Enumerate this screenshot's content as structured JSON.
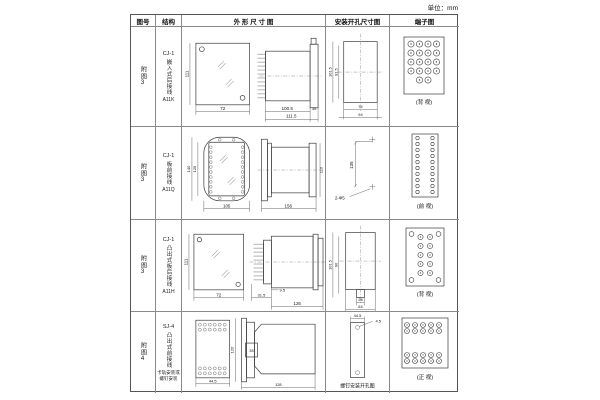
{
  "unit_note": "单位：mm",
  "headers": {
    "fig_no": "图号",
    "structure": "结构",
    "outline": "外 形 尺 寸 图",
    "install": "安装开孔尺寸图",
    "terminal": "端子图"
  },
  "rows": [
    {
      "fig_no": "附图3",
      "model": "CJ-1",
      "type": "嵌入式后接线",
      "code": "A11K",
      "outline": {
        "front_h": "111",
        "front_w": "72",
        "side_w1": "100.5",
        "side_w2": "111.5",
        "side_d": "35"
      },
      "install": {
        "v1": "101.5",
        "v2": "91.5",
        "h1": "74",
        "h2": "94"
      },
      "terminal_label": "(背 视)"
    },
    {
      "fig_no": "附图3",
      "model": "CJ-1",
      "type": "板前接线",
      "code": "A11Q",
      "outline": {
        "front_h1": "140",
        "front_h2": "125",
        "front_w": "105",
        "side_w": "156",
        "side_h": "110"
      },
      "install": {
        "v1": "135",
        "holes": "2-Φ5"
      },
      "terminal_label": "(前 视)"
    },
    {
      "fig_no": "附图3",
      "model": "CJ-1",
      "type": "凸出式板后接线",
      "code": "A11H",
      "outline": {
        "front_h": "111",
        "front_w": "72",
        "side_w1": "31.5",
        "side_w2": "9.5",
        "side_w3": "126"
      },
      "install": {
        "v1": "101.5",
        "v2": "90",
        "h1": "28",
        "h2": "64"
      },
      "terminal_label": "(背 视)"
    },
    {
      "fig_no": "附图4",
      "model": "SJ-4",
      "type": "凸出式前接线",
      "note": "卡轨安装或螺钉安装",
      "outline": {
        "front_w": "44.5",
        "side_h": "120",
        "side_d": "35",
        "side_w": "128"
      },
      "install": {
        "h1": "44.5",
        "holes": "4.5",
        "caption": "螺钉安装开孔图"
      },
      "terminal_label": "(正 视)"
    }
  ]
}
